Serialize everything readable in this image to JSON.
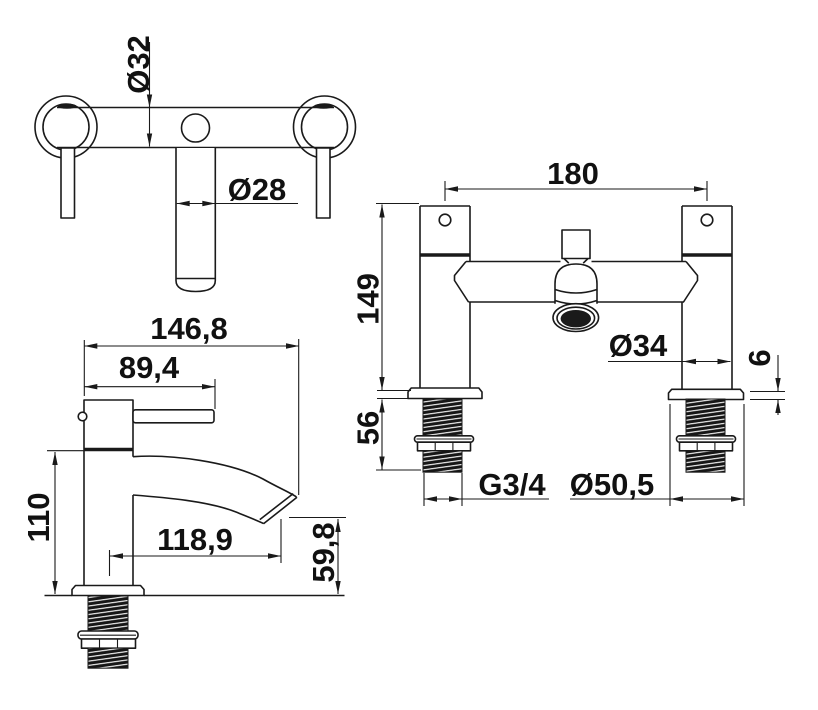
{
  "background_color": "#ffffff",
  "line_color": "#1a1a1a",
  "views": {
    "plan": {
      "dims": {
        "body_diameter": "Ø32",
        "spout_diameter": "Ø28"
      }
    },
    "side": {
      "dims": {
        "overall_depth": "146,8",
        "handle_reach": "89,4",
        "body_height": "110",
        "spout_reach": "118,9",
        "spout_height": "59,8"
      }
    },
    "front": {
      "dims": {
        "centres": "180",
        "body_height": "149",
        "tail_length": "56",
        "body_diameter": "Ø34",
        "flange_thickness": "6",
        "thread_size": "G3/4",
        "flange_diameter": "Ø50,5"
      }
    }
  }
}
